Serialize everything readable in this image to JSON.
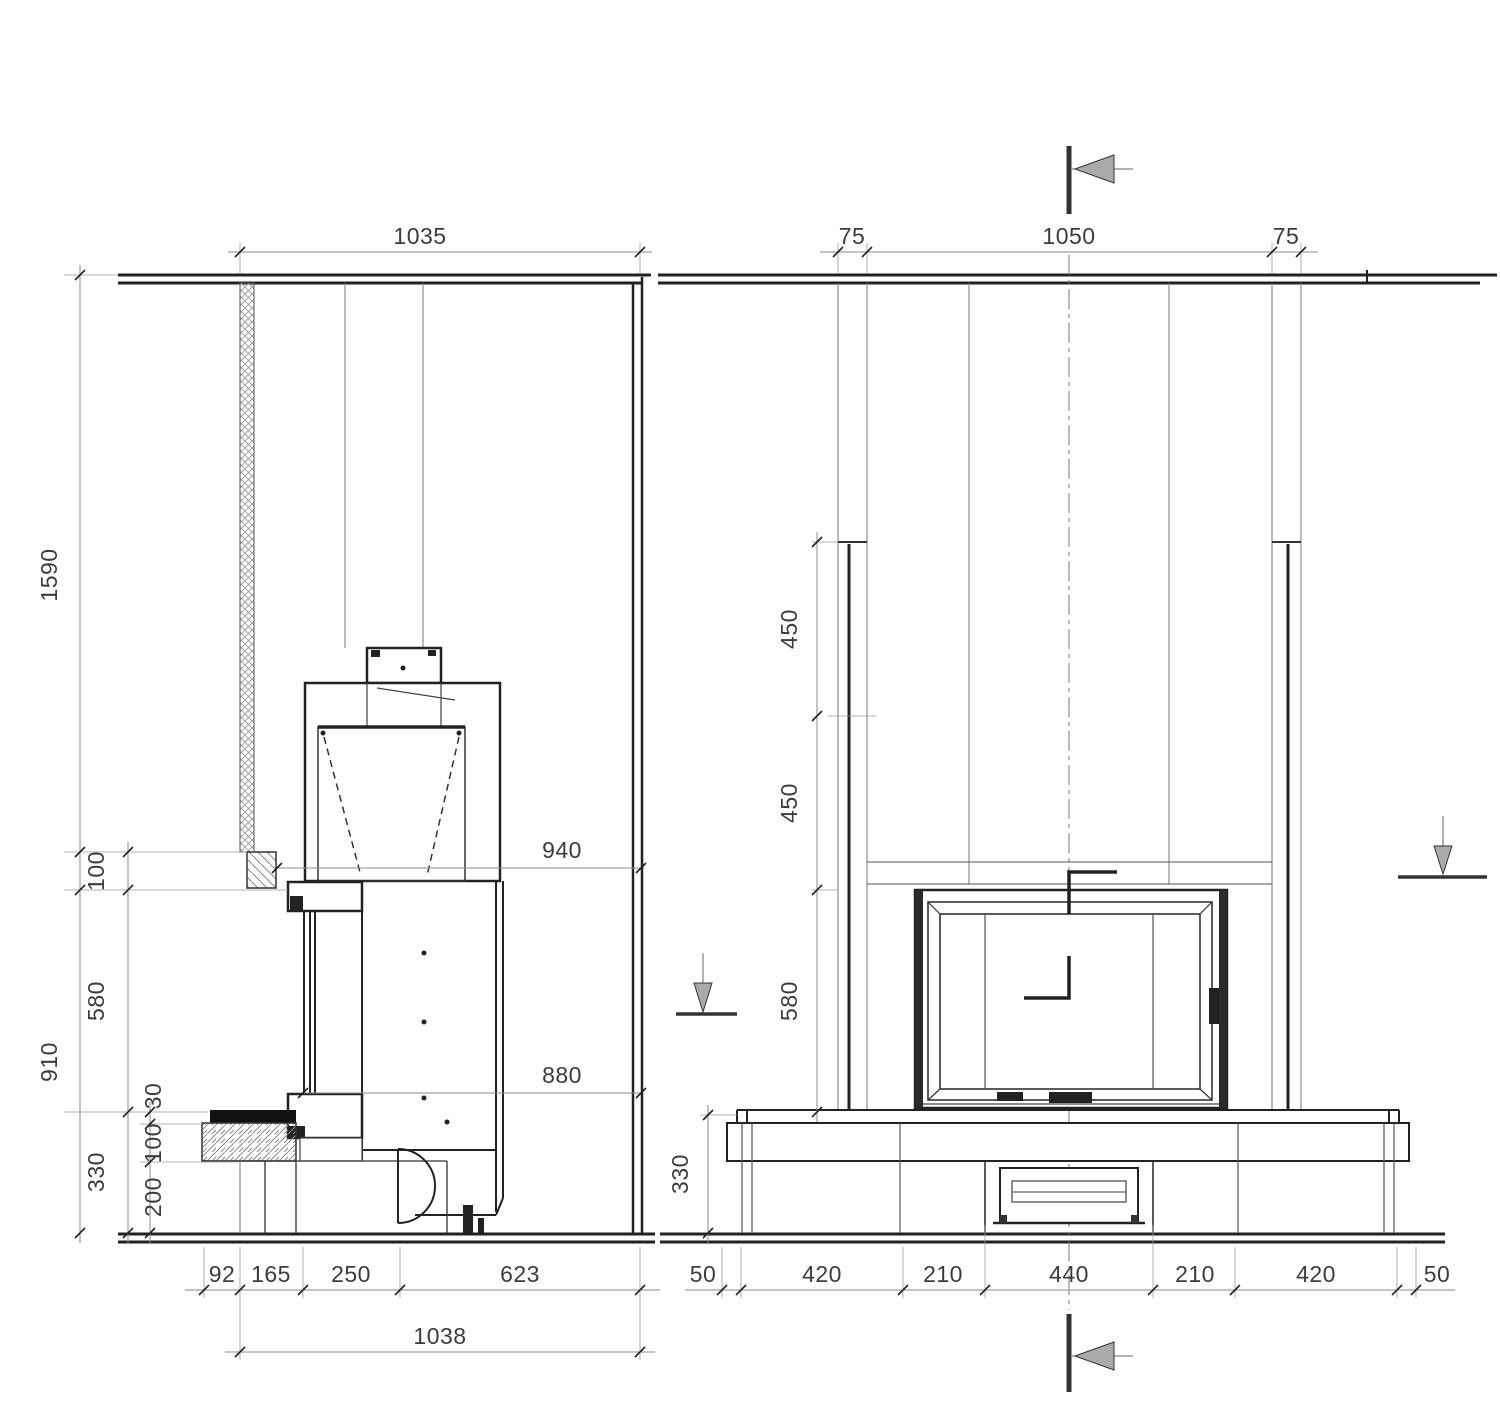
{
  "page": {
    "background": "#ffffff",
    "line_color": "#222222",
    "dim_line_color": "#8a8a8a",
    "hatch_color": "#9a9a9a",
    "text_color": "#3c3c3c"
  },
  "side_view": {
    "dims": {
      "width_top": "1035",
      "height_ceiling_to_flue": "1590",
      "height_stove": "910",
      "flue_offset": "100",
      "door_height": "580",
      "base_total": "330",
      "hearth_plate": "30",
      "bench_slab": "100",
      "plinth": "200",
      "wall_to_flue": "940",
      "wall_to_glass": "880",
      "b_92": "92",
      "b_165": "165",
      "b_250": "250",
      "b_623": "623",
      "total_depth": "1038"
    }
  },
  "front_view": {
    "dims": {
      "col_left": "75",
      "span_center": "1050",
      "col_right": "75",
      "upper_450": "450",
      "mid_450": "450",
      "door_580": "580",
      "base_330": "330",
      "b_50_l": "50",
      "b_420_l": "420",
      "b_210_l": "210",
      "b_440": "440",
      "b_210_r": "210",
      "b_420_r": "420",
      "b_50_r": "50"
    }
  }
}
